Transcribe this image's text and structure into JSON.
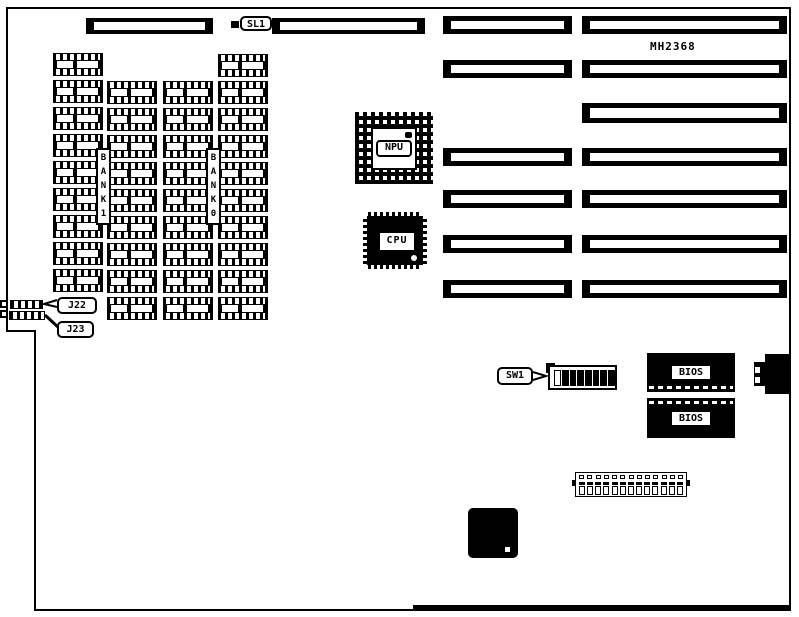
{
  "board": {
    "model": "MH2368",
    "labels": {
      "sl1": "SL1",
      "bank1": "B\nA\nN\nK\n1",
      "bank0": "B\nA\nN\nK\n0",
      "npu": "NPU",
      "cpu": "CPU",
      "sw1": "SW1",
      "bios_top": "BIOS",
      "bios_bottom": "BIOS",
      "j22": "J22",
      "j23": "J23"
    }
  },
  "memory": {
    "columns": [
      {
        "name": "column-1",
        "sockets": 9
      },
      {
        "name": "column-2",
        "sockets": 9
      },
      {
        "name": "column-3",
        "sockets": 9
      },
      {
        "name": "column-4",
        "sockets": 10
      }
    ]
  },
  "sw1_switch": {
    "states": [
      "off",
      "on",
      "on",
      "on",
      "on",
      "on",
      "on",
      "on"
    ]
  },
  "power_connector": {
    "pins_per_row": 13
  },
  "colors": {
    "ink": "#000000",
    "paper": "#ffffff"
  }
}
